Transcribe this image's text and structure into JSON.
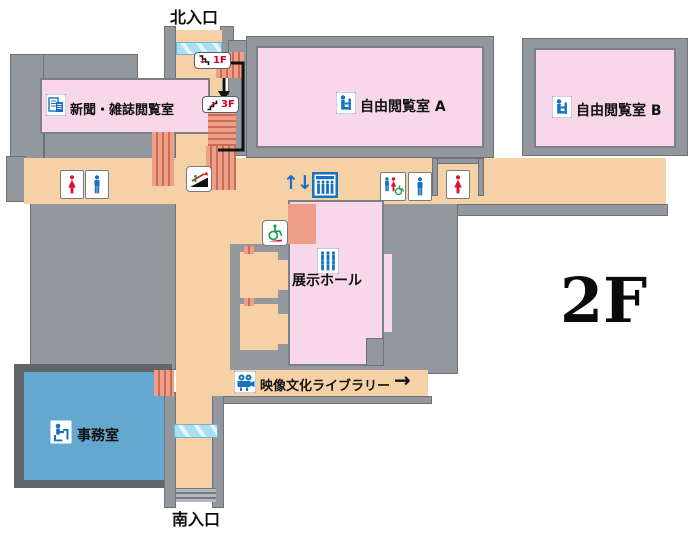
{
  "floor": {
    "label": "2F"
  },
  "entrances": {
    "north": "北入口",
    "south": "南入口"
  },
  "rooms": {
    "newspaper": {
      "label": "新聞・雑誌閲覧室"
    },
    "reading_a": {
      "label": "自由閲覧室 A"
    },
    "reading_b": {
      "label": "自由閲覧室 B"
    },
    "exhibition": {
      "label": "展示ホール"
    },
    "av_library": {
      "label": "映像文化ライブラリー",
      "direction_arrow": "→"
    },
    "office": {
      "label": "事務室"
    }
  },
  "signs": {
    "stairs_down_floor": "1F",
    "stairs_up_floor": "3F",
    "elevator_updown": "↑↓"
  },
  "icons": {
    "newspaper": "newspaper-icon",
    "reading": "reading-person-icon",
    "crowd": "crowd-icon",
    "projector": "film-projector-icon",
    "office_desk": "office-desk-icon",
    "elevator": "elevator-icon",
    "escalator": "escalator-icon",
    "wheelchair_ramp": "wheelchair-ramp-icon",
    "female_toilet": "female-toilet-icon",
    "male_toilet": "male-toilet-icon",
    "multipurpose_toilet": "multipurpose-toilet-icon",
    "stairs_down": "stairs-down-icon",
    "stairs_up": "stairs-up-icon",
    "right_arrow": "right-arrow-icon"
  },
  "colors": {
    "wall_gray": "#92989e",
    "wall_dark": "#60666c",
    "floor_peach": "#f6d1a6",
    "room_pink": "#f8d7e8",
    "room_blue": "#64a8cf",
    "stair_salmon": "#ef9f87",
    "glass_blue": "#aadff2",
    "icon_blue": "#1472bf",
    "toilet_red": "#dd1438",
    "wheelchair_green": "#1a9e4b",
    "route_black": "#111111"
  }
}
